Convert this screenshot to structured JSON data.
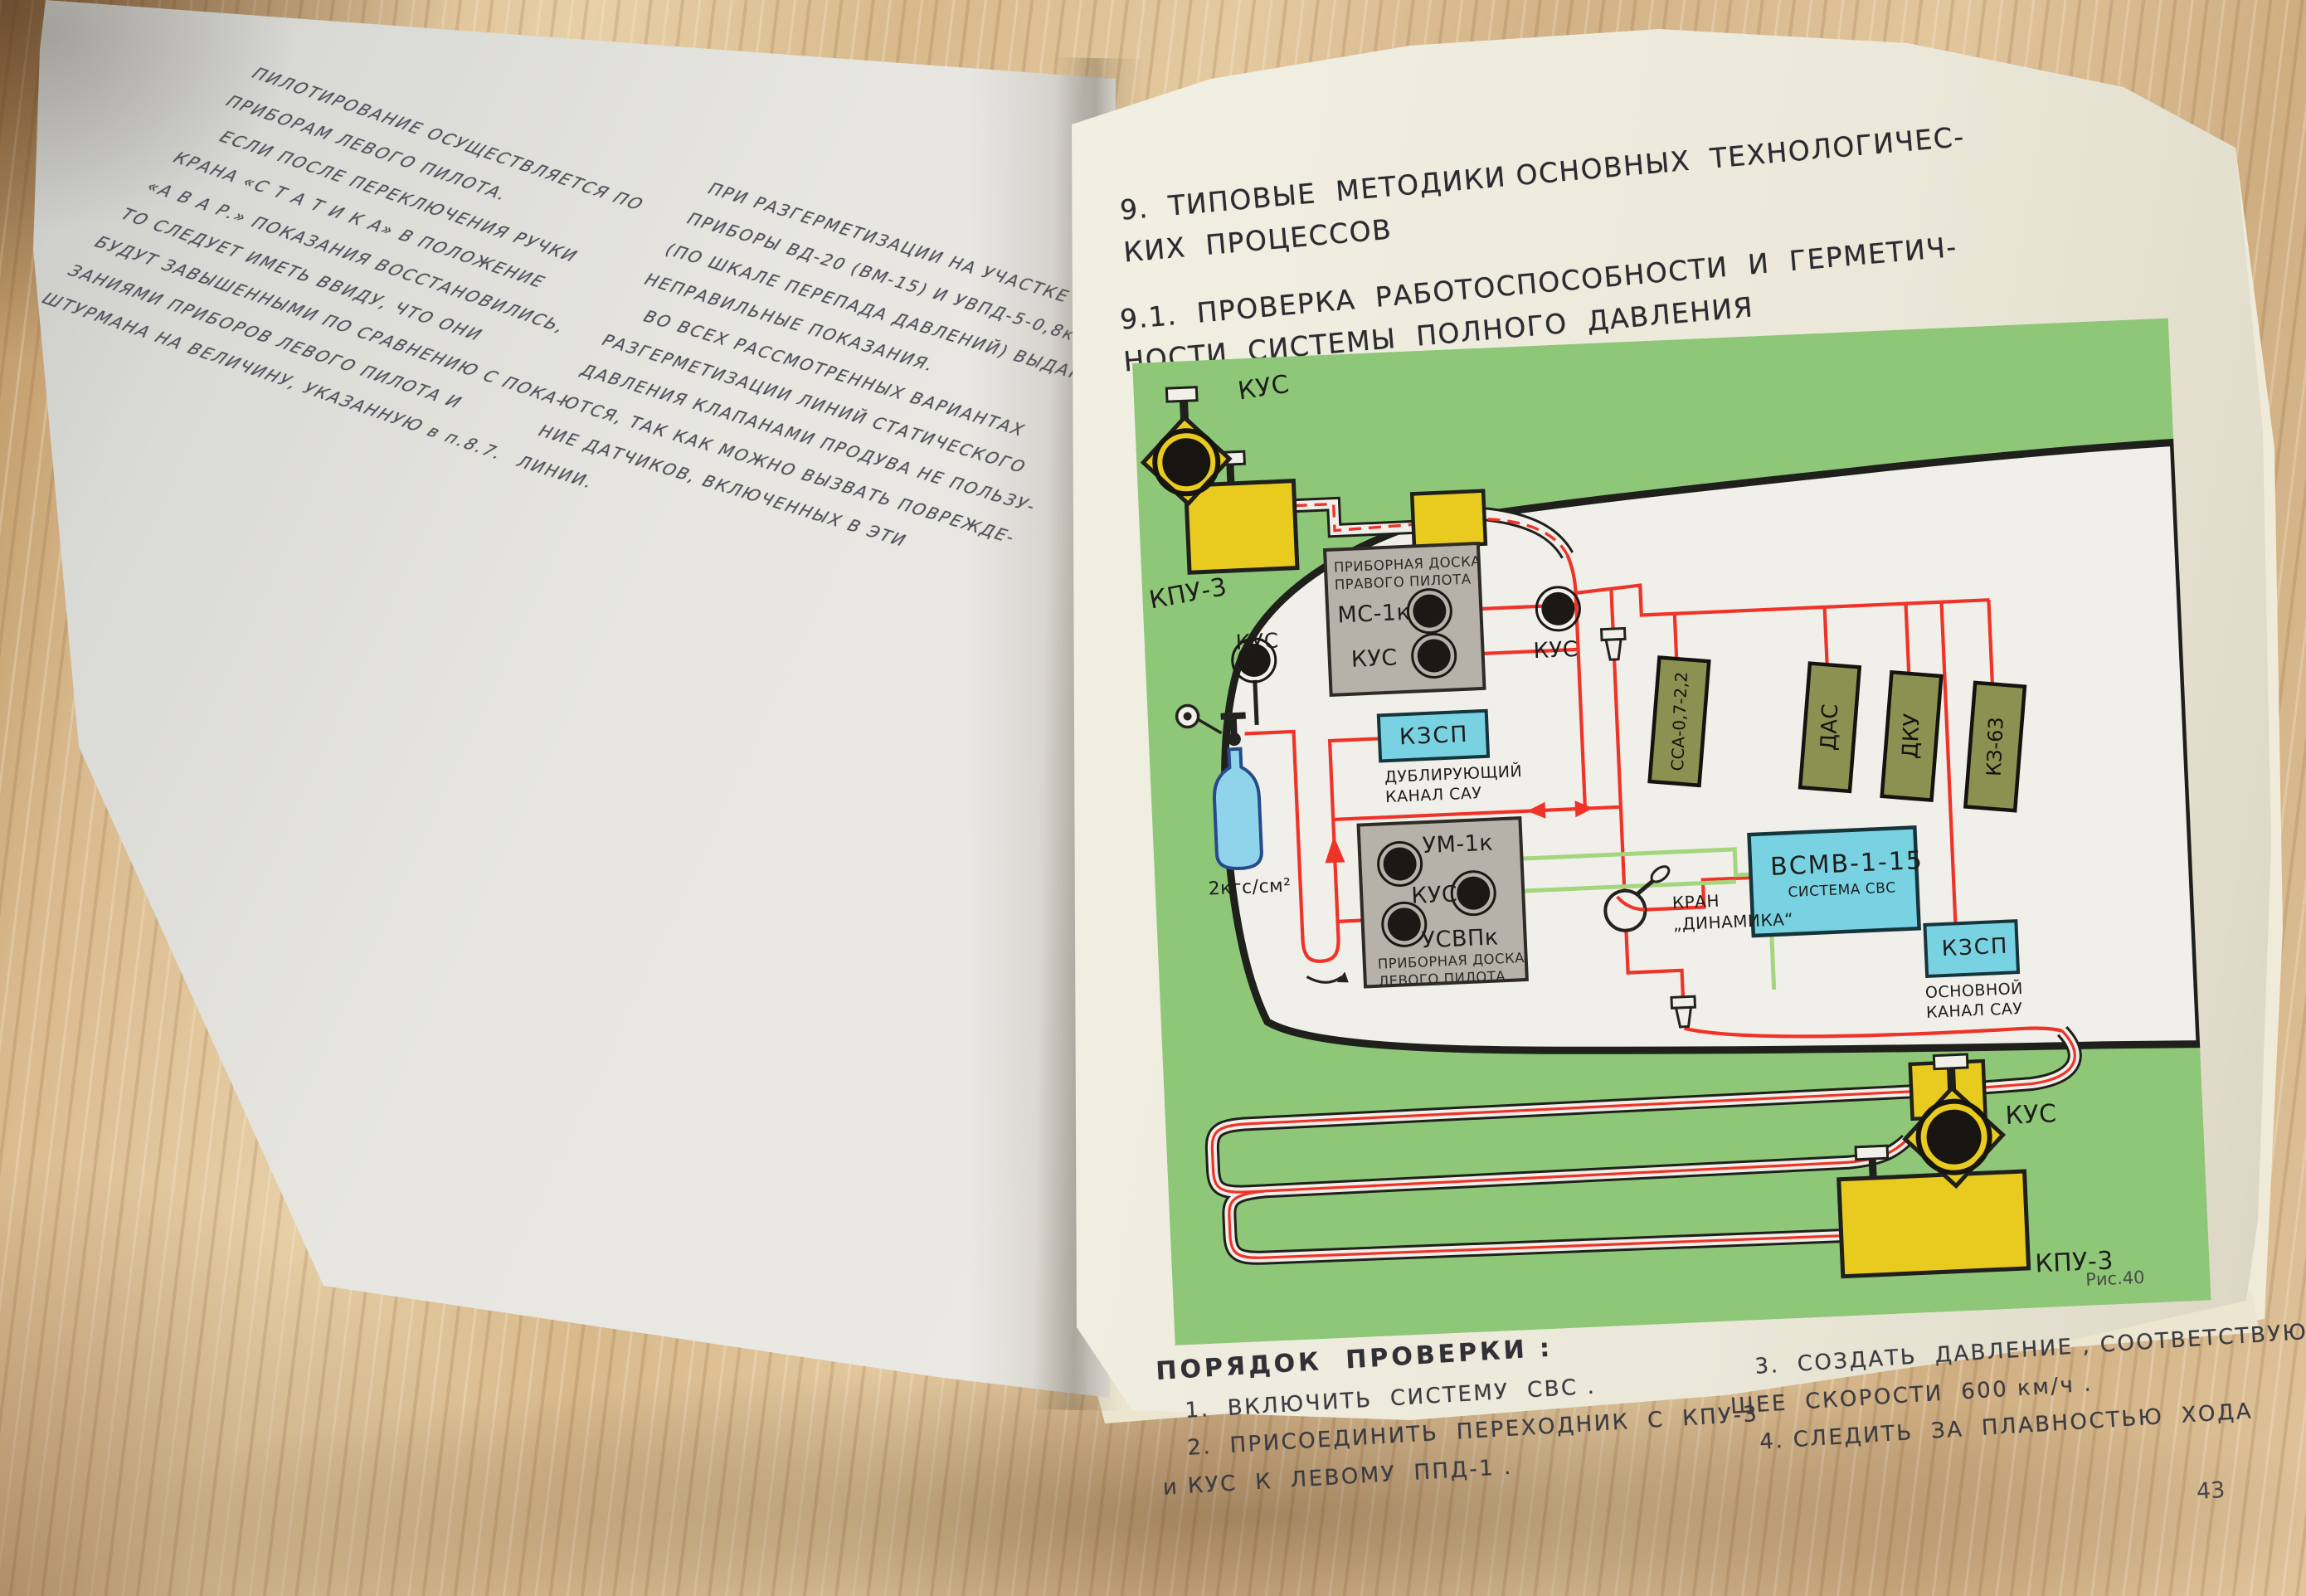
{
  "book": {
    "left_page": {
      "para1": "ПИЛОТИРОВАНИЕ ОСУЩЕСТВЛЯЕТСЯ ПО\nПРИБОРАМ ЛЕВОГО ПИЛОТА.\n   ЕСЛИ ПОСЛЕ ПЕРЕКЛЮЧЕНИЯ РУЧКИ\nКРАНА «С Т А Т И К А» В ПОЛОЖЕНИЕ\n«А В А Р.» ПОКАЗАНИЯ ВОССТАНОВИЛИСЬ,\nТО СЛЕДУЕТ ИМЕТЬ ВВИДУ, ЧТО ОНИ\nБУДУТ ЗАВЫШЕННЫМИ ПО СРАВНЕНИЮ С ПОКА-\nЗАНИЯМИ ПРИБОРОВ ЛЕВОГО ПИЛОТА И\nШТУРМАНА НА ВЕЛИЧИНУ, УКАЗАННУЮ в п.8.7.",
      "para2": "ПРИ РАЗГЕРМЕТИЗАЦИИ НА УЧАСТКЕ „А“\nПРИБОРЫ ВД-20 (ВМ-15) И УВПД-5-0,8к\n(ПО ШКАЛЕ ПЕРЕПАДА ДАВЛЕНИЙ) ВЫДАЮТ\nНЕПРАВИЛЬНЫЕ ПОКАЗАНИЯ.\n   ВО ВСЕХ РАССМОТРЕННЫХ ВАРИАНТАХ\nРАЗГЕРМЕТИЗАЦИИ ЛИНИЙ СТАТИЧЕСКОГО\nДАВЛЕНИЯ КЛАПАНАМИ ПРОДУВА НЕ ПОЛЬЗУ-\nЮТСЯ, ТАК КАК МОЖНО ВЫЗВАТЬ ПОВРЕЖДЕ-\nНИЕ ДАТЧИКОВ, ВКЛЮЧЕННЫХ В ЭТИ\nЛИНИИ."
    },
    "right_page": {
      "heading_section": "9.  ТИПОВЫЕ  МЕТОДИКИ ОСНОВНЫХ  ТЕХНОЛОГИЧЕС-\nКИХ  ПРОЦЕССОВ",
      "heading_sub": "9.1.  ПРОВЕРКА  РАБОТОСПОСОБНОСТИ  И  ГЕРМЕТИЧ-\nНОСТИ  СИСТЕМЫ  ПОЛНОГО  ДАВЛЕНИЯ",
      "figure_caption": "Рис.40",
      "page_number": "43",
      "procedure": {
        "title": "ПОРЯДОК  ПРОВЕРКИ :",
        "item1": "   1.  ВКЛЮЧИТЬ  СИСТЕМУ  СВС .",
        "item2": "   2.  ПРИСОЕДИНИТЬ  ПЕРЕХОДНИК  С  КПУ-3\nи КУС  К  ЛЕВОМУ  ППД-1 .",
        "item3": "   3.  СОЗДАТЬ  ДАВЛЕНИЕ , СООТВЕТСТВУЮ-\nЩЕЕ  СКОРОСТИ  600 км/ч .",
        "item4": "   4. СЛЕДИТЬ  ЗА  ПЛАВНОСТЬЮ  ХОДА"
      }
    },
    "diagram": {
      "labels": {
        "kus_upper": "КУС",
        "kpu3_upper": "КПУ-3",
        "panel_right_title": "ПРИБОРНАЯ ДОСКА\nПРАВОГО ПИЛОТА",
        "ms1k": "МС-1к",
        "kus_right_panel": "КУС",
        "kus_mid": "КУС",
        "kzsp_dub": "КЗСП",
        "kzsp_dub_sub": "ДУБЛИРУЮЩИЙ\nКАНАЛ САУ",
        "pressure": "2кгс/см²",
        "kus_inner_left": "КУС",
        "um1k": "УМ-1к",
        "kus_left_panel": "КУС",
        "usvpk": "УСВПк",
        "panel_left_title": "ПРИБОРНАЯ ДОСКА\nЛЕВОГО ПИЛОТА",
        "kran_dinamika": "КРАН\n„ДИНАМИКА“",
        "vsmv": "ВСМВ-1-15",
        "vsmv_sub": "СИСТЕМА СВС",
        "ssa": "ССА-0,7-2,2",
        "das": "ДАС",
        "dku": "ДКУ",
        "kz63": "КЗ-63",
        "kzsp_main": "КЗСП",
        "kzsp_main_sub": "ОСНОВНОЙ\nКАНАЛ САУ",
        "kus_lower": "КУС",
        "kpu3_lower": "КПУ-3"
      },
      "colors": {
        "panel_green": "#8fc779",
        "line_red": "#f03328",
        "line_green": "#a4d67d",
        "device_yellow": "#e9cb1f",
        "box_cyan": "#79d2e2",
        "box_olive": "#8b9150",
        "panel_gray": "#b6b2aa",
        "bottle_blue": "#8fd4ea"
      }
    }
  }
}
